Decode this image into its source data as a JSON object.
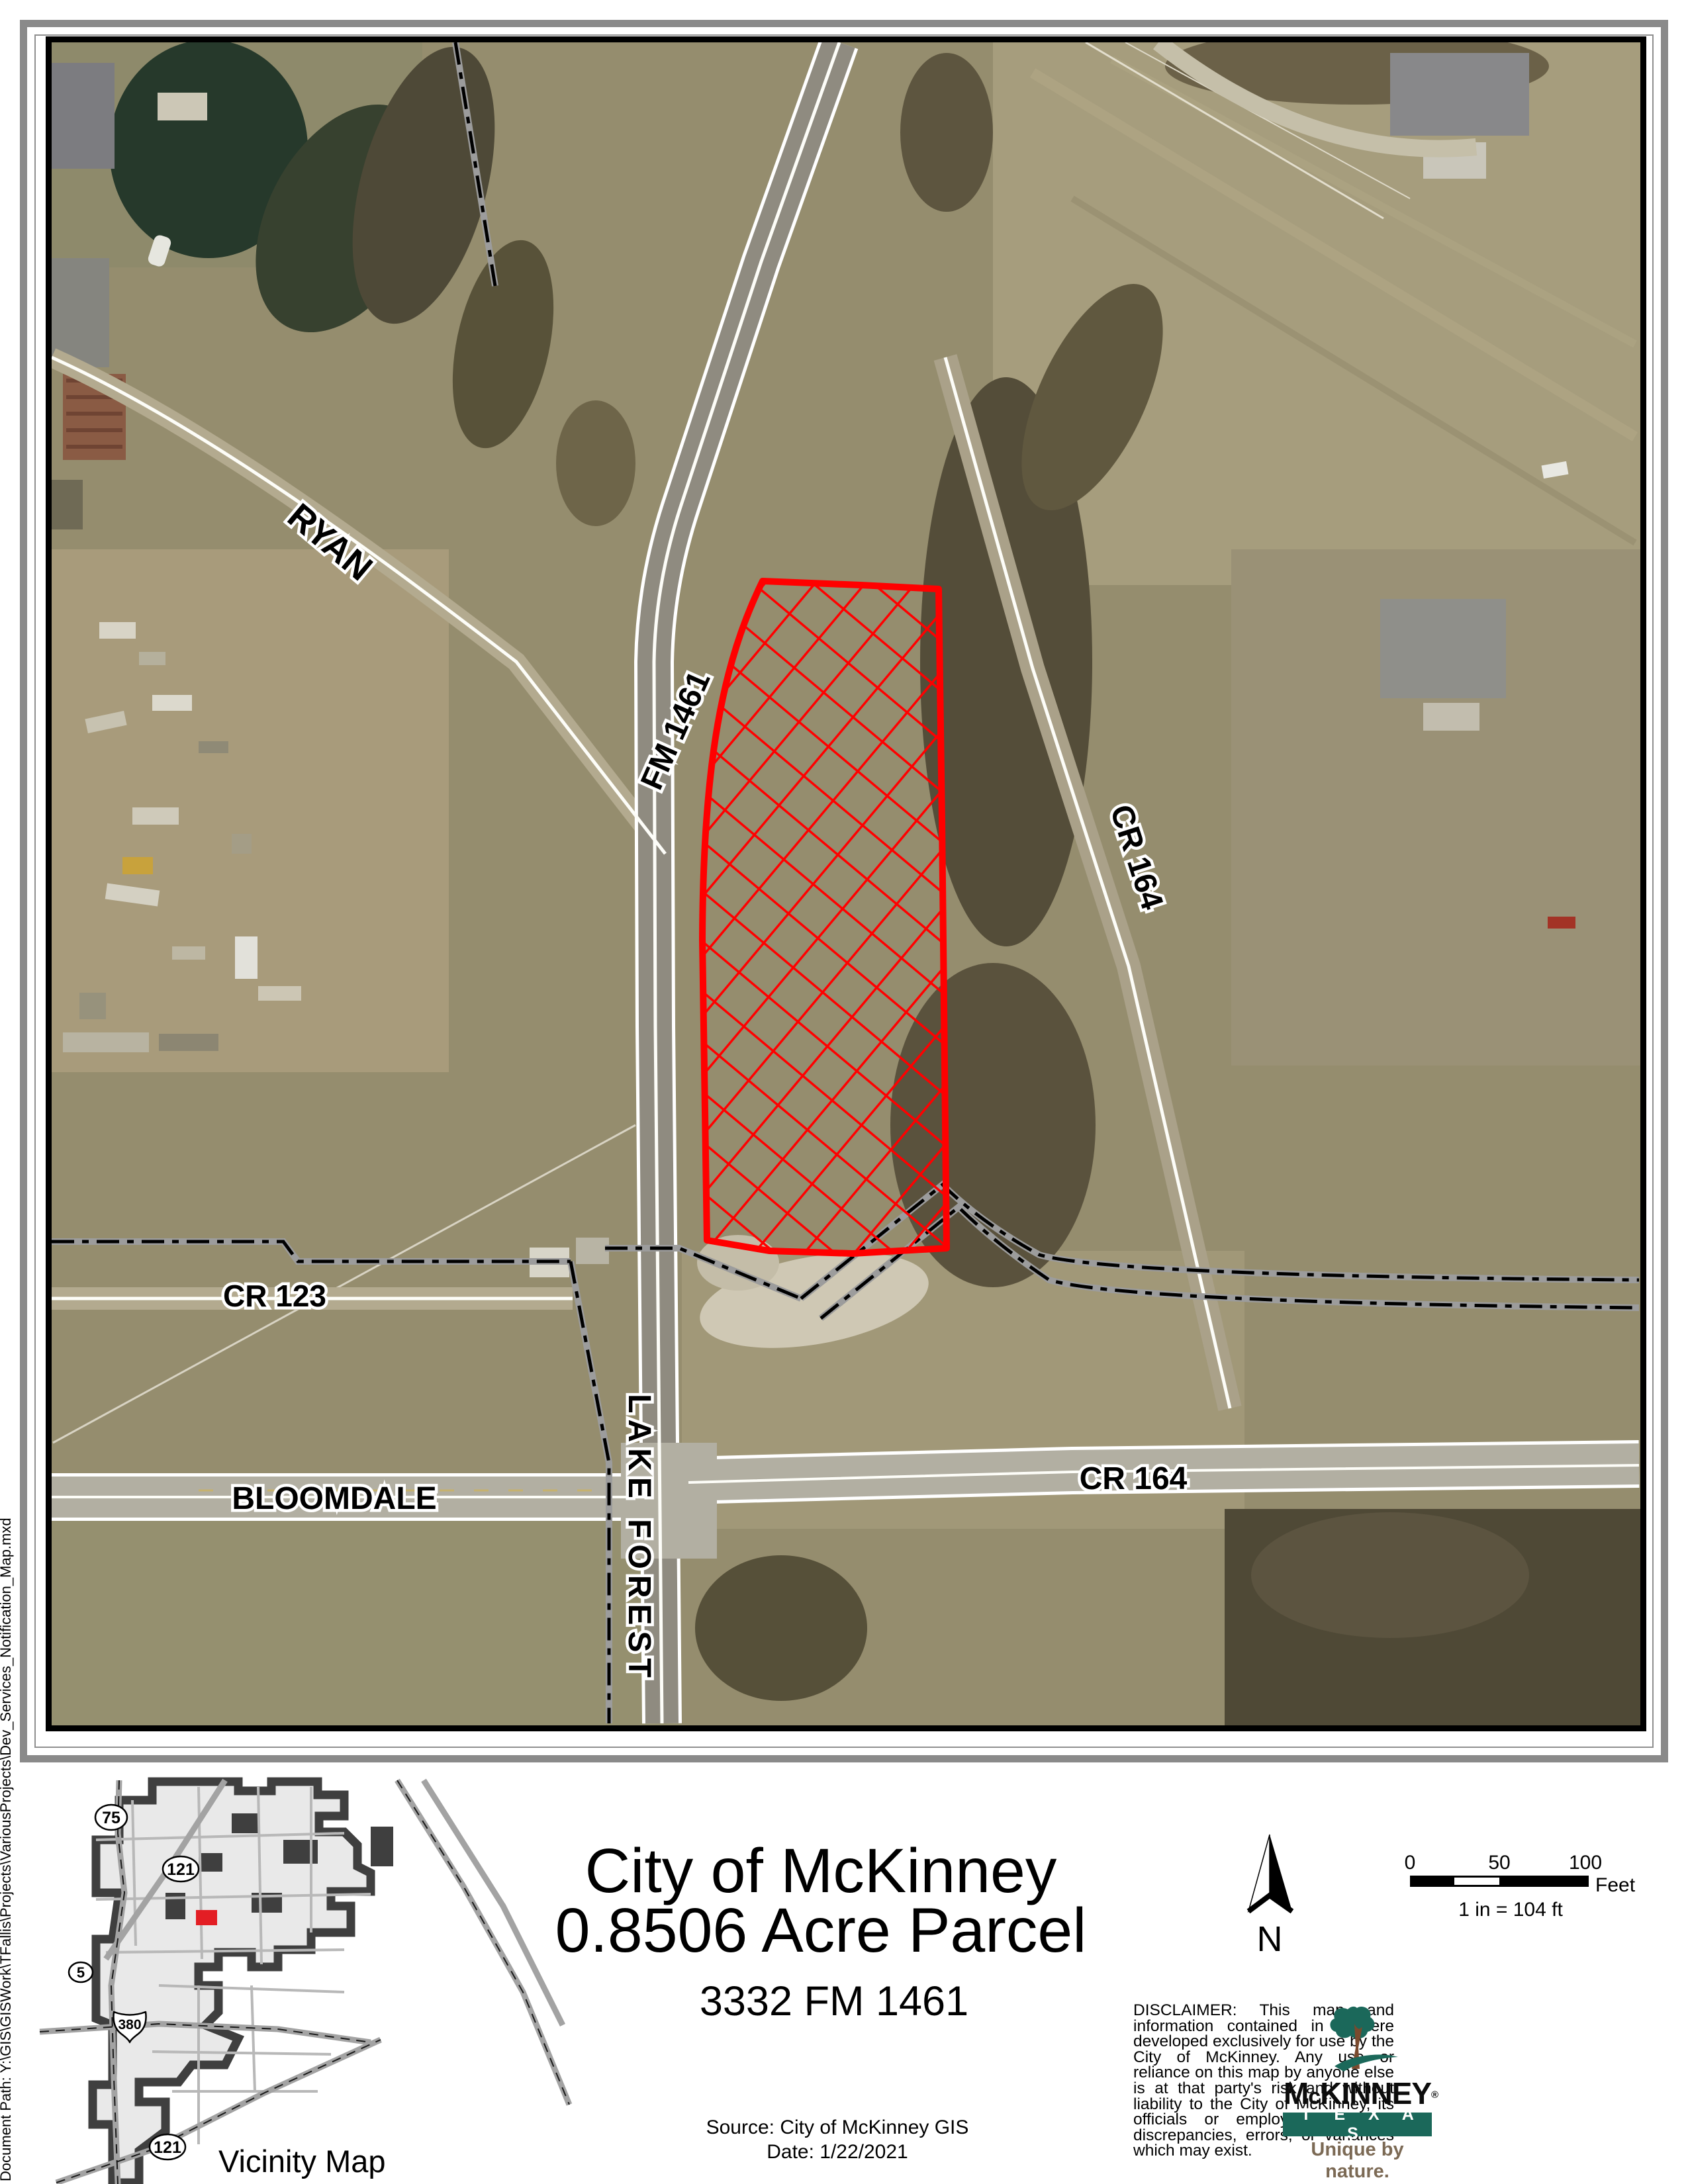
{
  "doc_path": "Document Path: Y:\\GIS\\GISWork\\TFallis\\Projects\\VariousProjects\\Dev_Services_Notification_Map.mxd",
  "map": {
    "labels": [
      {
        "text": "RYAN"
      },
      {
        "text": "FM 1461"
      },
      {
        "text": "CR 164"
      },
      {
        "text": "CR 123"
      },
      {
        "text": "BLOOMDALE"
      },
      {
        "text": "LAKE FOREST"
      },
      {
        "text": "CR 164"
      }
    ]
  },
  "title": {
    "line1": "City of McKinney",
    "line2": "0.8506 Acre Parcel",
    "address": "3332 FM 1461",
    "source": "Source: City of McKinney GIS",
    "date": "Date: 1/22/2021"
  },
  "north_label": "N",
  "scalebar": {
    "tick0": "0",
    "tick50": "50",
    "tick100": "100",
    "unit": "Feet",
    "ratio": "1 in = 104 ft"
  },
  "vicinity": {
    "title": "Vicinity Map",
    "shields": [
      {
        "num": "75"
      },
      {
        "num": "121"
      },
      {
        "num": "5"
      },
      {
        "num": "380"
      },
      {
        "num": "121"
      }
    ]
  },
  "disclaimer": "DISCLAIMER:  This map and information contained in it were developed exclusively for use by the City of McKinney.  Any use or reliance on this map by anyone else is at that party's risk and without liability to the City of McKinney, its officials or employees for any discrepancies, errors, or variances which may exist.",
  "logo": {
    "name_m": "M",
    "name_c": "c",
    "name_rest": "KINNEY",
    "reg": "®",
    "state": "T E X A S",
    "tagline": "Unique by nature."
  },
  "colors": {
    "parcel_red": "#FF0000",
    "marker_red": "#E31E24",
    "logo_teal": "#1B685A",
    "tagline_brown": "#7C6A55",
    "frame_gray": "#8A8A8A"
  }
}
